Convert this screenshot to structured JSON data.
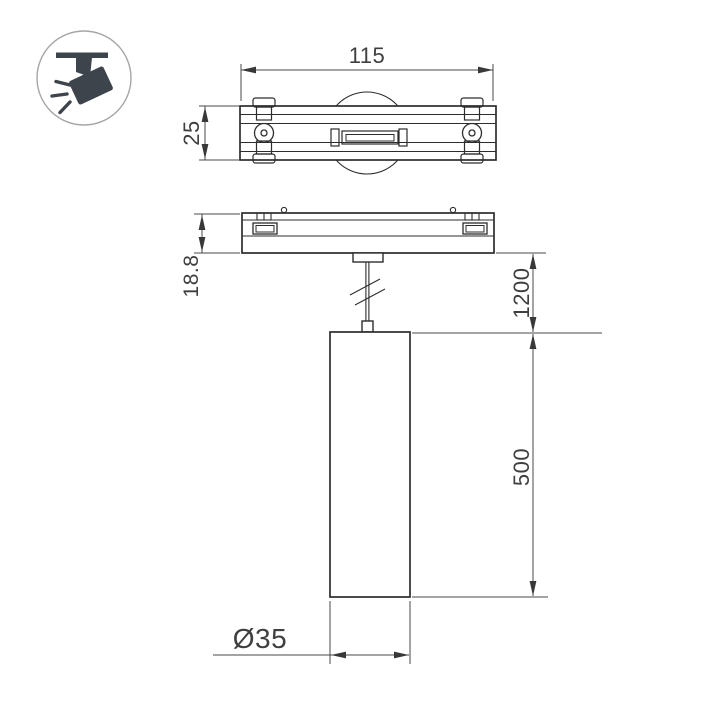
{
  "drawing": {
    "kind": "pendant-track-light-dimension-drawing",
    "icon": {
      "name": "track-spotlight-pictogram"
    },
    "dimensions": {
      "track_width": "115",
      "track_depth": "25",
      "base_height": "18.8",
      "suspension_length": "1200",
      "lamp_height": "500",
      "lamp_diameter": "Ø35"
    },
    "colors": {
      "background": "#ffffff",
      "outline": "#2d2d2d",
      "dimension_lines": "#4a4a4a",
      "dimension_text": "#3f3f3f",
      "icon_glyph": "#3e444c",
      "icon_ring": "#a6a6a6"
    }
  }
}
